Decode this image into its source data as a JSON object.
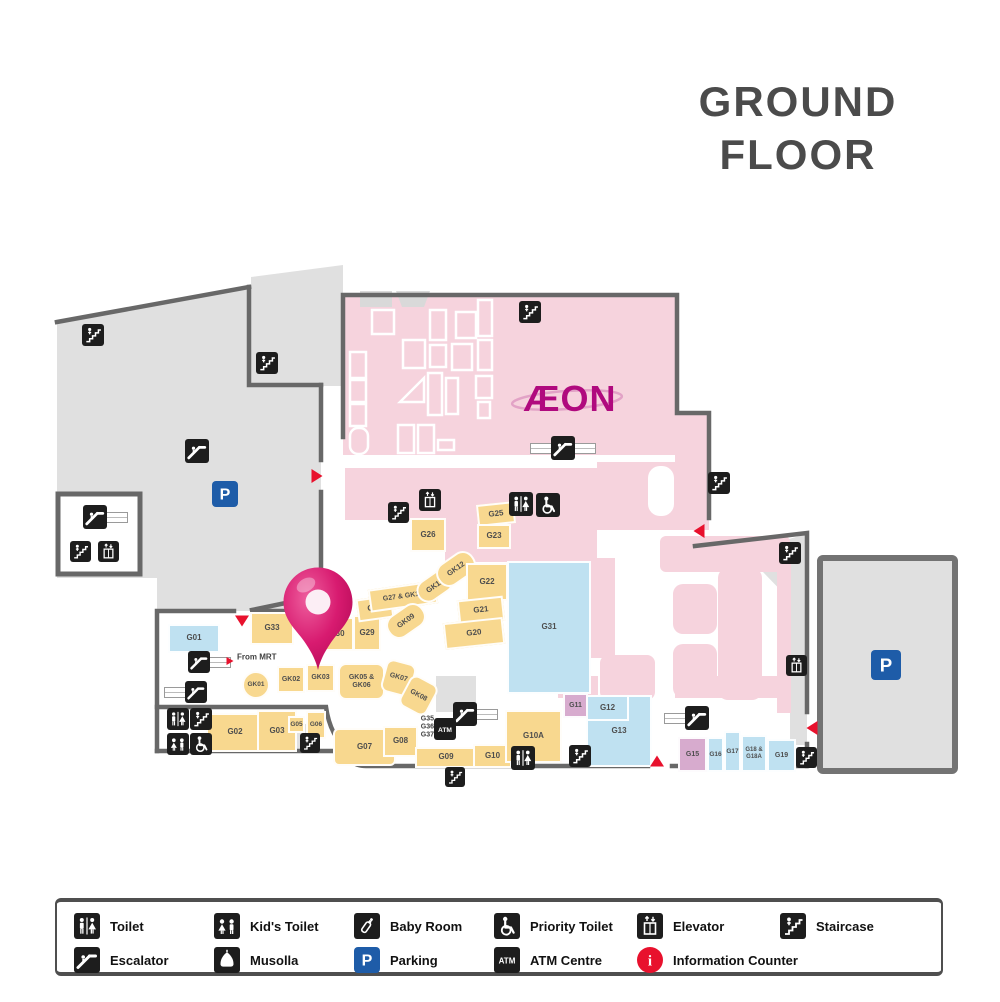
{
  "title": {
    "line1": "GROUND",
    "line2": "FLOOR"
  },
  "store_logo": "ÆON",
  "colors": {
    "yellow": "#f8d88f",
    "blue": "#bfe1f1",
    "purple": "#d7abce",
    "pink": "#f6d3dd",
    "gray": "#e0e0e0",
    "wall": "#686868",
    "red": "#e8112d",
    "parking_blue": "#1e5ca8",
    "icon_bg": "#1d1d1d",
    "pin": "#cf1065",
    "aeon": "#b00a7e",
    "title": "#4b4b4b",
    "label": "#4e4e4e"
  },
  "map": {
    "units": [
      {
        "id": "G01",
        "label": "G01",
        "x": 168,
        "y": 624,
        "w": 52,
        "h": 29,
        "c": "blue"
      },
      {
        "id": "G33",
        "label": "G33",
        "x": 250,
        "y": 612,
        "w": 44,
        "h": 33,
        "c": "yellow"
      },
      {
        "id": "G30",
        "label": "G30",
        "x": 320,
        "y": 617,
        "w": 34,
        "h": 34,
        "c": "yellow"
      },
      {
        "id": "G29",
        "label": "G29",
        "x": 353,
        "y": 615,
        "w": 28,
        "h": 36,
        "c": "yellow"
      },
      {
        "id": "G28",
        "label": "G28",
        "x": 357,
        "y": 597,
        "w": 36,
        "h": 23,
        "c": "yellow",
        "rot": -8
      },
      {
        "id": "G27-GK10",
        "label": "G27 & GK10",
        "x": 369,
        "y": 585,
        "w": 68,
        "h": 23,
        "c": "yellow",
        "rot": -8,
        "fs": 7
      },
      {
        "id": "GK09",
        "label": "GK09",
        "x": 385,
        "y": 608,
        "w": 42,
        "h": 26,
        "c": "yellow",
        "rot": -35,
        "r": 12,
        "fs": 7.5
      },
      {
        "id": "GK11",
        "label": "GK11",
        "x": 415,
        "y": 574,
        "w": 40,
        "h": 24,
        "c": "yellow",
        "rot": -35,
        "r": 12,
        "fs": 7.5
      },
      {
        "id": "GK12",
        "label": "GK12",
        "x": 435,
        "y": 556,
        "w": 42,
        "h": 26,
        "c": "yellow",
        "rot": -35,
        "r": 12,
        "fs": 7.5
      },
      {
        "id": "G26",
        "label": "G26",
        "x": 410,
        "y": 518,
        "w": 36,
        "h": 34,
        "c": "yellow"
      },
      {
        "id": "G25",
        "label": "G25",
        "x": 477,
        "y": 503,
        "w": 38,
        "h": 22,
        "c": "yellow",
        "rot": -6
      },
      {
        "id": "G23",
        "label": "G23",
        "x": 477,
        "y": 524,
        "w": 34,
        "h": 25,
        "c": "yellow"
      },
      {
        "id": "G22",
        "label": "G22",
        "x": 466,
        "y": 563,
        "w": 42,
        "h": 38,
        "c": "yellow"
      },
      {
        "id": "G21",
        "label": "G21",
        "x": 458,
        "y": 598,
        "w": 46,
        "h": 25,
        "c": "yellow",
        "rot": -6
      },
      {
        "id": "G20",
        "label": "G20",
        "x": 444,
        "y": 620,
        "w": 60,
        "h": 27,
        "c": "yellow",
        "rot": -6
      },
      {
        "id": "G31",
        "label": "G31",
        "x": 507,
        "y": 561,
        "w": 84,
        "h": 133,
        "c": "blue"
      },
      {
        "id": "GK01",
        "label": "GK01",
        "x": 242,
        "y": 671,
        "w": 28,
        "h": 28,
        "c": "yellow",
        "shape": "circle",
        "fs": 6.5
      },
      {
        "id": "GK02",
        "label": "GK02",
        "x": 277,
        "y": 666,
        "w": 28,
        "h": 27,
        "c": "yellow",
        "fs": 7
      },
      {
        "id": "GK03",
        "label": "GK03",
        "x": 306,
        "y": 664,
        "w": 29,
        "h": 28,
        "c": "yellow",
        "fs": 7
      },
      {
        "id": "GK05-GK06",
        "label": "GK05 &\nGK06",
        "x": 338,
        "y": 663,
        "w": 47,
        "h": 37,
        "c": "yellow",
        "r": 8,
        "fs": 7
      },
      {
        "id": "GK07",
        "label": "GK07",
        "x": 383,
        "y": 661,
        "w": 31,
        "h": 34,
        "c": "yellow",
        "rot": 15,
        "r": 8,
        "fs": 7
      },
      {
        "id": "GK08",
        "label": "GK08",
        "x": 403,
        "y": 678,
        "w": 31,
        "h": 35,
        "c": "yellow",
        "rot": 28,
        "r": 8,
        "fs": 7
      },
      {
        "id": "G02",
        "label": "G02",
        "x": 206,
        "y": 713,
        "w": 58,
        "h": 39,
        "c": "yellow"
      },
      {
        "id": "G03",
        "label": "G03",
        "x": 257,
        "y": 710,
        "w": 40,
        "h": 42,
        "c": "yellow"
      },
      {
        "id": "G05",
        "label": "G05",
        "x": 288,
        "y": 716,
        "w": 17,
        "h": 17,
        "c": "yellow",
        "fs": 6.5
      },
      {
        "id": "G06",
        "label": "G06",
        "x": 306,
        "y": 711,
        "w": 20,
        "h": 28,
        "c": "yellow",
        "fs": 6.5
      },
      {
        "id": "G07",
        "label": "G07",
        "x": 333,
        "y": 728,
        "w": 63,
        "h": 38,
        "c": "yellow",
        "r": 6
      },
      {
        "id": "G08",
        "label": "G08",
        "x": 383,
        "y": 726,
        "w": 35,
        "h": 31,
        "c": "yellow"
      },
      {
        "id": "G09",
        "label": "G09",
        "x": 415,
        "y": 747,
        "w": 62,
        "h": 21,
        "c": "yellow"
      },
      {
        "id": "G10",
        "label": "G10",
        "x": 473,
        "y": 744,
        "w": 39,
        "h": 24,
        "c": "yellow"
      },
      {
        "id": "G10A",
        "label": "G10A",
        "x": 505,
        "y": 710,
        "w": 57,
        "h": 53,
        "c": "yellow"
      },
      {
        "id": "G13",
        "label": "G13",
        "x": 586,
        "y": 695,
        "w": 66,
        "h": 72,
        "c": "blue"
      },
      {
        "id": "G12",
        "label": "G12",
        "x": 586,
        "y": 695,
        "w": 43,
        "h": 26,
        "c": "blue"
      },
      {
        "id": "G11",
        "label": "G11",
        "x": 563,
        "y": 693,
        "w": 25,
        "h": 25,
        "c": "purple",
        "fs": 7
      },
      {
        "id": "G15",
        "label": "G15",
        "x": 678,
        "y": 737,
        "w": 29,
        "h": 35,
        "c": "purple",
        "fs": 7
      },
      {
        "id": "G16",
        "label": "G16",
        "x": 707,
        "y": 737,
        "w": 17,
        "h": 35,
        "c": "blue",
        "fs": 6.5
      },
      {
        "id": "G17",
        "label": "G17",
        "x": 724,
        "y": 731,
        "w": 17,
        "h": 41,
        "c": "blue",
        "fs": 6.5
      },
      {
        "id": "G18-G18A",
        "label": "G18 &\nG18A",
        "x": 741,
        "y": 735,
        "w": 26,
        "h": 37,
        "c": "blue",
        "fs": 6
      },
      {
        "id": "G19",
        "label": "G19",
        "x": 767,
        "y": 739,
        "w": 29,
        "h": 33,
        "c": "blue",
        "fs": 7
      }
    ],
    "labels": [
      {
        "id": "from-mrt",
        "text": "From MRT",
        "x": 237,
        "y": 657,
        "fs": 8,
        "align": "left"
      },
      {
        "id": "g35",
        "text": "G35",
        "x": 434,
        "y": 719,
        "fs": 7,
        "align": "right"
      },
      {
        "id": "g36",
        "text": "G36",
        "x": 434,
        "y": 727,
        "fs": 7,
        "align": "right"
      },
      {
        "id": "g37",
        "text": "G37",
        "x": 434,
        "y": 735,
        "fs": 7,
        "align": "right"
      }
    ],
    "icons": [
      {
        "type": "staircase",
        "x": 93,
        "y": 335,
        "s": 22
      },
      {
        "type": "staircase",
        "x": 267,
        "y": 363,
        "s": 22
      },
      {
        "type": "escalator",
        "x": 197,
        "y": 451,
        "s": 24
      },
      {
        "type": "parking",
        "x": 225,
        "y": 494,
        "s": 26
      },
      {
        "type": "escalator",
        "x": 95,
        "y": 517,
        "s": 24,
        "bars": "R"
      },
      {
        "type": "staircase",
        "x": 80,
        "y": 551,
        "s": 21
      },
      {
        "type": "elevator",
        "x": 108,
        "y": 551,
        "s": 21
      },
      {
        "type": "staircase",
        "x": 530,
        "y": 312,
        "s": 22
      },
      {
        "type": "escalator",
        "x": 563,
        "y": 448,
        "s": 24,
        "bars": "LR"
      },
      {
        "type": "staircase",
        "x": 398,
        "y": 512,
        "s": 21
      },
      {
        "type": "elevator",
        "x": 430,
        "y": 500,
        "s": 22
      },
      {
        "type": "toilet",
        "x": 521,
        "y": 504,
        "s": 24
      },
      {
        "type": "priority-toilet",
        "x": 548,
        "y": 505,
        "s": 24
      },
      {
        "type": "staircase",
        "x": 719,
        "y": 483,
        "s": 22
      },
      {
        "type": "staircase",
        "x": 790,
        "y": 553,
        "s": 22
      },
      {
        "type": "elevator",
        "x": 796,
        "y": 665,
        "s": 21
      },
      {
        "type": "staircase",
        "x": 806,
        "y": 757,
        "s": 21
      },
      {
        "type": "parking",
        "x": 886,
        "y": 665,
        "s": 30
      },
      {
        "type": "escalator",
        "x": 199,
        "y": 662,
        "s": 22,
        "bars": "R"
      },
      {
        "type": "escalator",
        "x": 196,
        "y": 692,
        "s": 22,
        "bars": "L"
      },
      {
        "type": "toilet",
        "x": 178,
        "y": 719,
        "s": 22
      },
      {
        "type": "staircase",
        "x": 201,
        "y": 719,
        "s": 22
      },
      {
        "type": "kids-toilet",
        "x": 178,
        "y": 744,
        "s": 22
      },
      {
        "type": "priority-toilet",
        "x": 201,
        "y": 744,
        "s": 22
      },
      {
        "type": "staircase",
        "x": 310,
        "y": 743,
        "s": 20
      },
      {
        "type": "escalator",
        "x": 465,
        "y": 714,
        "s": 24,
        "bars": "R"
      },
      {
        "type": "atm",
        "x": 445,
        "y": 729,
        "s": 22
      },
      {
        "type": "toilet",
        "x": 523,
        "y": 758,
        "s": 24
      },
      {
        "type": "staircase",
        "x": 455,
        "y": 777,
        "s": 20
      },
      {
        "type": "staircase",
        "x": 580,
        "y": 756,
        "s": 22
      },
      {
        "type": "escalator",
        "x": 697,
        "y": 718,
        "s": 24,
        "bars": "L"
      }
    ],
    "arrows": [
      {
        "dir": "right",
        "x": 317,
        "y": 476,
        "s": 1
      },
      {
        "dir": "down",
        "x": 242,
        "y": 621,
        "s": 1
      },
      {
        "dir": "right",
        "x": 230,
        "y": 661,
        "s": 0.65
      },
      {
        "dir": "left",
        "x": 699,
        "y": 531,
        "s": 1
      },
      {
        "dir": "up",
        "x": 657,
        "y": 761,
        "s": 1
      },
      {
        "dir": "left",
        "x": 812,
        "y": 728,
        "s": 1
      }
    ],
    "pin": {
      "x": 318,
      "y": 672
    }
  },
  "legend": {
    "items": [
      {
        "icon": "toilet",
        "label": "Toilet"
      },
      {
        "icon": "kids-toilet",
        "label": "Kid's Toilet"
      },
      {
        "icon": "baby-room",
        "label": "Baby Room"
      },
      {
        "icon": "priority-toilet",
        "label": "Priority Toilet"
      },
      {
        "icon": "elevator",
        "label": "Elevator"
      },
      {
        "icon": "staircase",
        "label": "Staircase"
      },
      {
        "icon": "escalator",
        "label": "Escalator"
      },
      {
        "icon": "musolla",
        "label": "Musolla"
      },
      {
        "icon": "parking",
        "label": "Parking"
      },
      {
        "icon": "atm",
        "label": "ATM Centre"
      },
      {
        "icon": "info",
        "label": "Information Counter"
      }
    ]
  }
}
